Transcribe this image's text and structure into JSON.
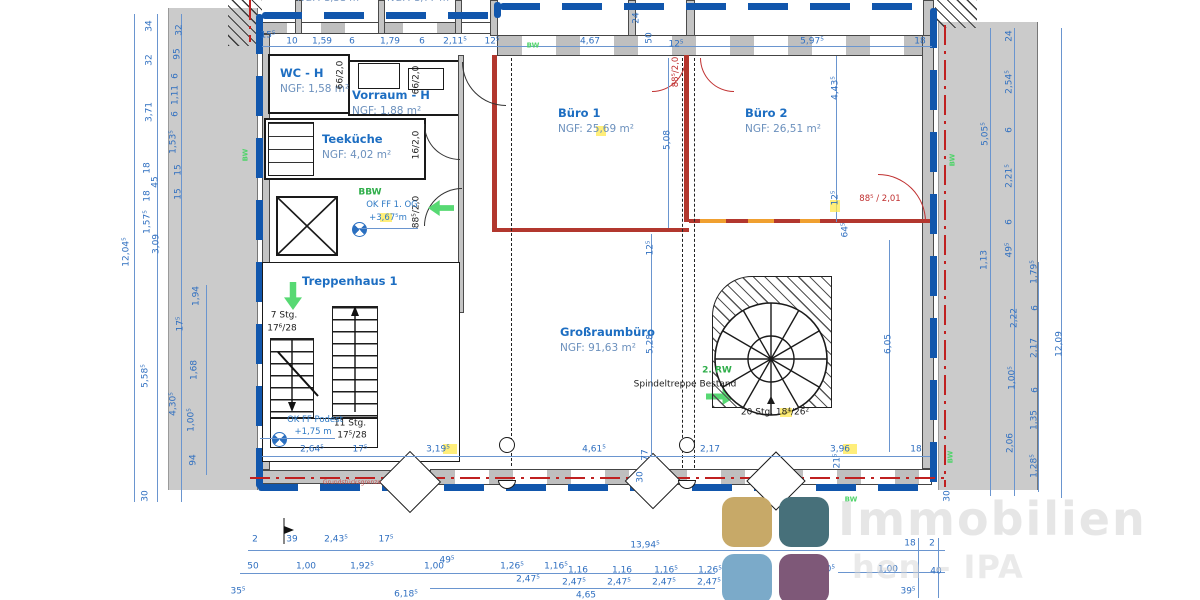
{
  "rooms": [
    {
      "name": "WC - H",
      "ngf": "NGF: 1,58 m²"
    },
    {
      "name": "Vorraum - H",
      "ngf": "NGF: 1,88 m²"
    },
    {
      "name": "Teeküche",
      "ngf": "NGF: 4,02 m²"
    },
    {
      "name": "Treppenhaus 1",
      "ngf": ""
    },
    {
      "name": "Büro 1",
      "ngf": "NGF: 25,69 m²"
    },
    {
      "name": "Büro 2",
      "ngf": "NGF: 26,51 m²"
    },
    {
      "name": "Großraumbüro",
      "ngf": "NGF: 91,63 m²"
    }
  ],
  "watermark": {
    "line1": "Immobilien",
    "line2": "hen – IPA"
  },
  "logo": {
    "colors": [
      "#c7a968",
      "#47707a",
      "#7baac9",
      "#7e5878"
    ]
  },
  "labels": [
    [
      "15⁵",
      268,
      36,
      0,
      "d"
    ],
    [
      "10",
      292,
      42,
      0,
      "d"
    ],
    [
      "1,59",
      322,
      42,
      0,
      "d"
    ],
    [
      "6",
      352,
      42,
      0,
      "d"
    ],
    [
      "1,79",
      390,
      42,
      0,
      "d"
    ],
    [
      "6",
      422,
      42,
      0,
      "d"
    ],
    [
      "2,11⁵",
      455,
      42,
      0,
      "d"
    ],
    [
      "12⁵",
      492,
      42,
      0,
      "d"
    ],
    [
      "4,67",
      590,
      42,
      0,
      "d"
    ],
    [
      "50",
      650,
      38,
      -90,
      "d"
    ],
    [
      "12⁵",
      676,
      45,
      0,
      "d"
    ],
    [
      "24",
      637,
      18,
      -90,
      "d"
    ],
    [
      "5,97⁵",
      812,
      42,
      0,
      "d"
    ],
    [
      "18",
      920,
      42,
      0,
      "d"
    ],
    [
      "12,04⁵",
      127,
      252,
      -90,
      "d"
    ],
    [
      "34",
      150,
      26,
      -90,
      "d"
    ],
    [
      "32",
      150,
      60,
      -90,
      "d"
    ],
    [
      "3,71",
      150,
      112,
      -90,
      "d"
    ],
    [
      "18",
      148,
      168,
      -90,
      "d"
    ],
    [
      "45",
      156,
      182,
      -90,
      "d"
    ],
    [
      "18",
      148,
      196,
      -90,
      "d"
    ],
    [
      "1,57⁵",
      148,
      222,
      -90,
      "d"
    ],
    [
      "3,09",
      157,
      244,
      -90,
      "d"
    ],
    [
      "5,58⁵",
      146,
      376,
      -90,
      "d"
    ],
    [
      "30",
      146,
      496,
      -90,
      "d"
    ],
    [
      "32",
      180,
      30,
      -90,
      "d"
    ],
    [
      "95",
      178,
      54,
      -90,
      "d"
    ],
    [
      "6",
      176,
      76,
      -90,
      "d"
    ],
    [
      "1,11",
      176,
      95,
      -90,
      "d"
    ],
    [
      "6",
      176,
      114,
      -90,
      "d"
    ],
    [
      "1,53⁵",
      174,
      142,
      -90,
      "d"
    ],
    [
      "15",
      179,
      170,
      -90,
      "d"
    ],
    [
      "15",
      179,
      194,
      -90,
      "d"
    ],
    [
      "4,30⁵",
      174,
      404,
      -90,
      "d"
    ],
    [
      "1,94",
      197,
      296,
      -90,
      "d"
    ],
    [
      "17⁵",
      181,
      324,
      -90,
      "d"
    ],
    [
      "1,68",
      195,
      370,
      -90,
      "d"
    ],
    [
      "1,00⁵",
      192,
      420,
      -90,
      "d"
    ],
    [
      "94",
      194,
      460,
      -90,
      "d"
    ],
    [
      "24",
      1010,
      36,
      -90,
      "d"
    ],
    [
      "2,54⁵",
      1010,
      82,
      -90,
      "d"
    ],
    [
      "6",
      1010,
      130,
      -90,
      "d"
    ],
    [
      "2,21⁵",
      1010,
      176,
      -90,
      "d"
    ],
    [
      "6",
      1010,
      222,
      -90,
      "d"
    ],
    [
      "49⁵",
      1010,
      250,
      -90,
      "d"
    ],
    [
      "5,05⁵",
      986,
      134,
      -90,
      "d"
    ],
    [
      "1,13",
      985,
      260,
      -90,
      "d"
    ],
    [
      "1,79⁵",
      1035,
      272,
      -90,
      "d"
    ],
    [
      "2,22",
      1015,
      318,
      -90,
      "d"
    ],
    [
      "6",
      1036,
      308,
      -90,
      "d"
    ],
    [
      "2,17",
      1035,
      348,
      -90,
      "d"
    ],
    [
      "1,00⁵",
      1013,
      378,
      -90,
      "d"
    ],
    [
      "6",
      1036,
      390,
      -90,
      "d"
    ],
    [
      "1,35",
      1035,
      420,
      -90,
      "d"
    ],
    [
      "2,06",
      1011,
      443,
      -90,
      "d"
    ],
    [
      "1,28⁵",
      1035,
      466,
      -90,
      "d"
    ],
    [
      "30",
      948,
      496,
      -90,
      "d"
    ],
    [
      "12,09",
      1060,
      344,
      -90,
      "d"
    ],
    [
      "5,08",
      668,
      140,
      -90,
      "d"
    ],
    [
      "4,43⁵",
      836,
      88,
      -90,
      "d"
    ],
    [
      "12⁵",
      836,
      198,
      -90,
      "d"
    ],
    [
      "64⁵",
      846,
      230,
      -90,
      "d"
    ],
    [
      "12⁵",
      651,
      248,
      -90,
      "d"
    ],
    [
      "5,28",
      651,
      344,
      -90,
      "d"
    ],
    [
      "6,05",
      889,
      344,
      -90,
      "d"
    ],
    [
      "77",
      646,
      455,
      -90,
      "d"
    ],
    [
      "30",
      641,
      477,
      -90,
      "d"
    ],
    [
      "21⁵",
      838,
      461,
      -90,
      "d"
    ],
    [
      "2,64⁵",
      312,
      450,
      0,
      "d"
    ],
    [
      "17⁵",
      360,
      450,
      0,
      "d"
    ],
    [
      "3,19⁵",
      438,
      450,
      0,
      "d"
    ],
    [
      "4,61⁵",
      594,
      450,
      0,
      "d"
    ],
    [
      "2,17",
      710,
      450,
      0,
      "d"
    ],
    [
      "3,96",
      840,
      450,
      0,
      "d"
    ],
    [
      "18",
      916,
      450,
      0,
      "d"
    ],
    [
      "2",
      255,
      540,
      0,
      "d"
    ],
    [
      "39",
      292,
      540,
      0,
      "d"
    ],
    [
      "2,43⁵",
      336,
      540,
      0,
      "d"
    ],
    [
      "17⁵",
      386,
      540,
      0,
      "d"
    ],
    [
      "13,94⁵",
      645,
      546,
      0,
      "d"
    ],
    [
      "18",
      910,
      544,
      0,
      "d"
    ],
    [
      "2",
      932,
      544,
      0,
      "d"
    ],
    [
      "50",
      253,
      567,
      0,
      "d"
    ],
    [
      "1,00",
      306,
      567,
      0,
      "d"
    ],
    [
      "1,92⁵",
      362,
      567,
      0,
      "d"
    ],
    [
      "1,00",
      434,
      567,
      0,
      "d"
    ],
    [
      "49⁵",
      447,
      561,
      0,
      "d"
    ],
    [
      "1,26⁵",
      512,
      567,
      0,
      "d"
    ],
    [
      "1,16⁵",
      556,
      567,
      0,
      "d"
    ],
    [
      "1,16",
      578,
      571,
      0,
      "d"
    ],
    [
      "1,16",
      622,
      571,
      0,
      "d"
    ],
    [
      "1,16⁵",
      666,
      571,
      0,
      "d"
    ],
    [
      "1,26⁵",
      710,
      571,
      0,
      "d"
    ],
    [
      "1",
      768,
      571,
      0,
      "d"
    ],
    [
      "2,0⁵",
      826,
      570,
      0,
      "d"
    ],
    [
      "1,00",
      888,
      570,
      0,
      "d"
    ],
    [
      "40",
      936,
      572,
      0,
      "d"
    ],
    [
      "2,47⁵",
      528,
      580,
      0,
      "d"
    ],
    [
      "2,47⁵",
      574,
      583,
      0,
      "d"
    ],
    [
      "2,47⁵",
      619,
      583,
      0,
      "d"
    ],
    [
      "2,47⁵",
      664,
      583,
      0,
      "d"
    ],
    [
      "2,47⁵",
      709,
      583,
      0,
      "d"
    ],
    [
      "35⁵",
      238,
      592,
      0,
      "d"
    ],
    [
      "6,18⁵",
      406,
      595,
      0,
      "d"
    ],
    [
      "4,65",
      586,
      596,
      0,
      "d"
    ],
    [
      "6,33",
      790,
      592,
      0,
      "d"
    ],
    [
      "39⁵",
      908,
      592,
      0,
      "d"
    ],
    [
      "7 Stg.",
      284,
      316,
      0,
      "k"
    ],
    [
      "17⁶/28",
      282,
      329,
      0,
      "k"
    ],
    [
      "11 Stg.",
      350,
      424,
      0,
      "k"
    ],
    [
      "17⁵/28",
      352,
      436,
      0,
      "k"
    ],
    [
      "Spindeltreppe Bestand",
      685,
      385,
      0,
      "k"
    ],
    [
      "20 Stg. 18⁴/26²",
      775,
      413,
      0,
      "k"
    ],
    [
      "66/2,0",
      341,
      75,
      -90,
      "k"
    ],
    [
      "66/2,0",
      417,
      80,
      -90,
      "k"
    ],
    [
      "16/2,0",
      417,
      145,
      -90,
      "k"
    ],
    [
      "88⁵/2,0",
      417,
      212,
      -90,
      "k"
    ],
    [
      "OK FF 1. OG",
      392,
      205,
      0,
      "b"
    ],
    [
      "+3,67⁵m",
      388,
      218,
      0,
      "b"
    ],
    [
      "OK FF Podest",
      315,
      420,
      0,
      "b"
    ],
    [
      "+1,75 m",
      313,
      432,
      0,
      "b"
    ],
    [
      "BBW",
      370,
      193,
      0,
      "g"
    ],
    [
      "2. RW",
      717,
      371,
      0,
      "g"
    ],
    [
      "BW",
      533,
      46,
      0,
      "gt"
    ],
    [
      "BW",
      851,
      500,
      0,
      "gt"
    ],
    [
      "BW",
      246,
      155,
      -90,
      "gt"
    ],
    [
      "BW",
      953,
      160,
      -90,
      "gt"
    ],
    [
      "BW",
      951,
      457,
      -90,
      "gt"
    ],
    [
      "88⁵ / 2,01",
      880,
      199,
      0,
      "r"
    ],
    [
      "88⁵/2,0",
      676,
      72,
      -90,
      "r"
    ],
    [
      "Grundstücksgrenze",
      352,
      483,
      0,
      "t"
    ],
    [
      "NGF: 1,31 m²",
      330,
      -1,
      0,
      "n"
    ],
    [
      "NGF: 1,77 m²",
      420,
      -1,
      0,
      "n"
    ]
  ]
}
